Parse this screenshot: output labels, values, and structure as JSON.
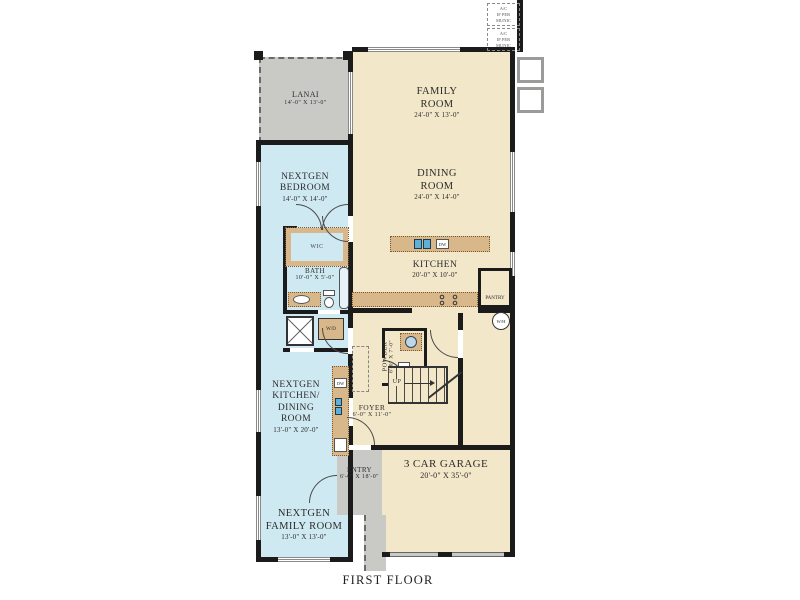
{
  "title": "FIRST FLOOR",
  "colors": {
    "wall": "#1b1b1b",
    "living_fill": "#f2e7c8",
    "nextgen_fill": "#cfe9f2",
    "outdoor_fill": "#c9c9c6",
    "cabinet_fill": "#d8b88b",
    "sink_blue": "#5db0d8"
  },
  "rooms": {
    "lanai": {
      "lines": [
        "LANAI"
      ],
      "dims": "14'-0\" X 13'-0\""
    },
    "family": {
      "lines": [
        "FAMILY",
        "ROOM"
      ],
      "dims": "24'-0\" X 13'-0\""
    },
    "dining": {
      "lines": [
        "DINING",
        "ROOM"
      ],
      "dims": "24'-0\" X 14'-0\""
    },
    "nextgen_bedroom": {
      "lines": [
        "NEXTGEN",
        "BEDROOM"
      ],
      "dims": "14'-0\" X 14'-0\""
    },
    "bath": {
      "lines": [
        "BATH"
      ],
      "dims": "10'-0\" X 5'-0\""
    },
    "kitchen": {
      "lines": [
        "KITCHEN"
      ],
      "dims": "20'-0\" X 10'-0\""
    },
    "powder": {
      "lines": [
        "POWDER"
      ],
      "dims": "6'-0\" X 7'-0\""
    },
    "foyer": {
      "lines": [
        "FOYER"
      ],
      "dims": "6'-0\" X 11'-0\""
    },
    "nextgen_kitchen": {
      "lines": [
        "NEXTGEN",
        "KITCHEN/",
        "DINING",
        "ROOM"
      ],
      "dims": "13'-0\" X 20'-0\""
    },
    "entry": {
      "lines": [
        "ENTRY"
      ],
      "dims": "6'-0\" X 18'-0\""
    },
    "garage": {
      "lines": [
        "3 CAR GARAGE"
      ],
      "dims": "20'-0\" X 35'-0\""
    },
    "nextgen_family": {
      "lines": [
        "NEXTGEN",
        "FAMILY ROOM"
      ],
      "dims": "13'-0\" X 13'-0\""
    }
  },
  "fixtures": {
    "wic": "WIC",
    "wd": "W/D",
    "wh": "W/H",
    "dw": "DW",
    "up": "UP",
    "pantry": "PANTRY"
  },
  "annotations": {
    "ac_note": [
      "A/C",
      "IF PER",
      "MUNIC"
    ]
  }
}
